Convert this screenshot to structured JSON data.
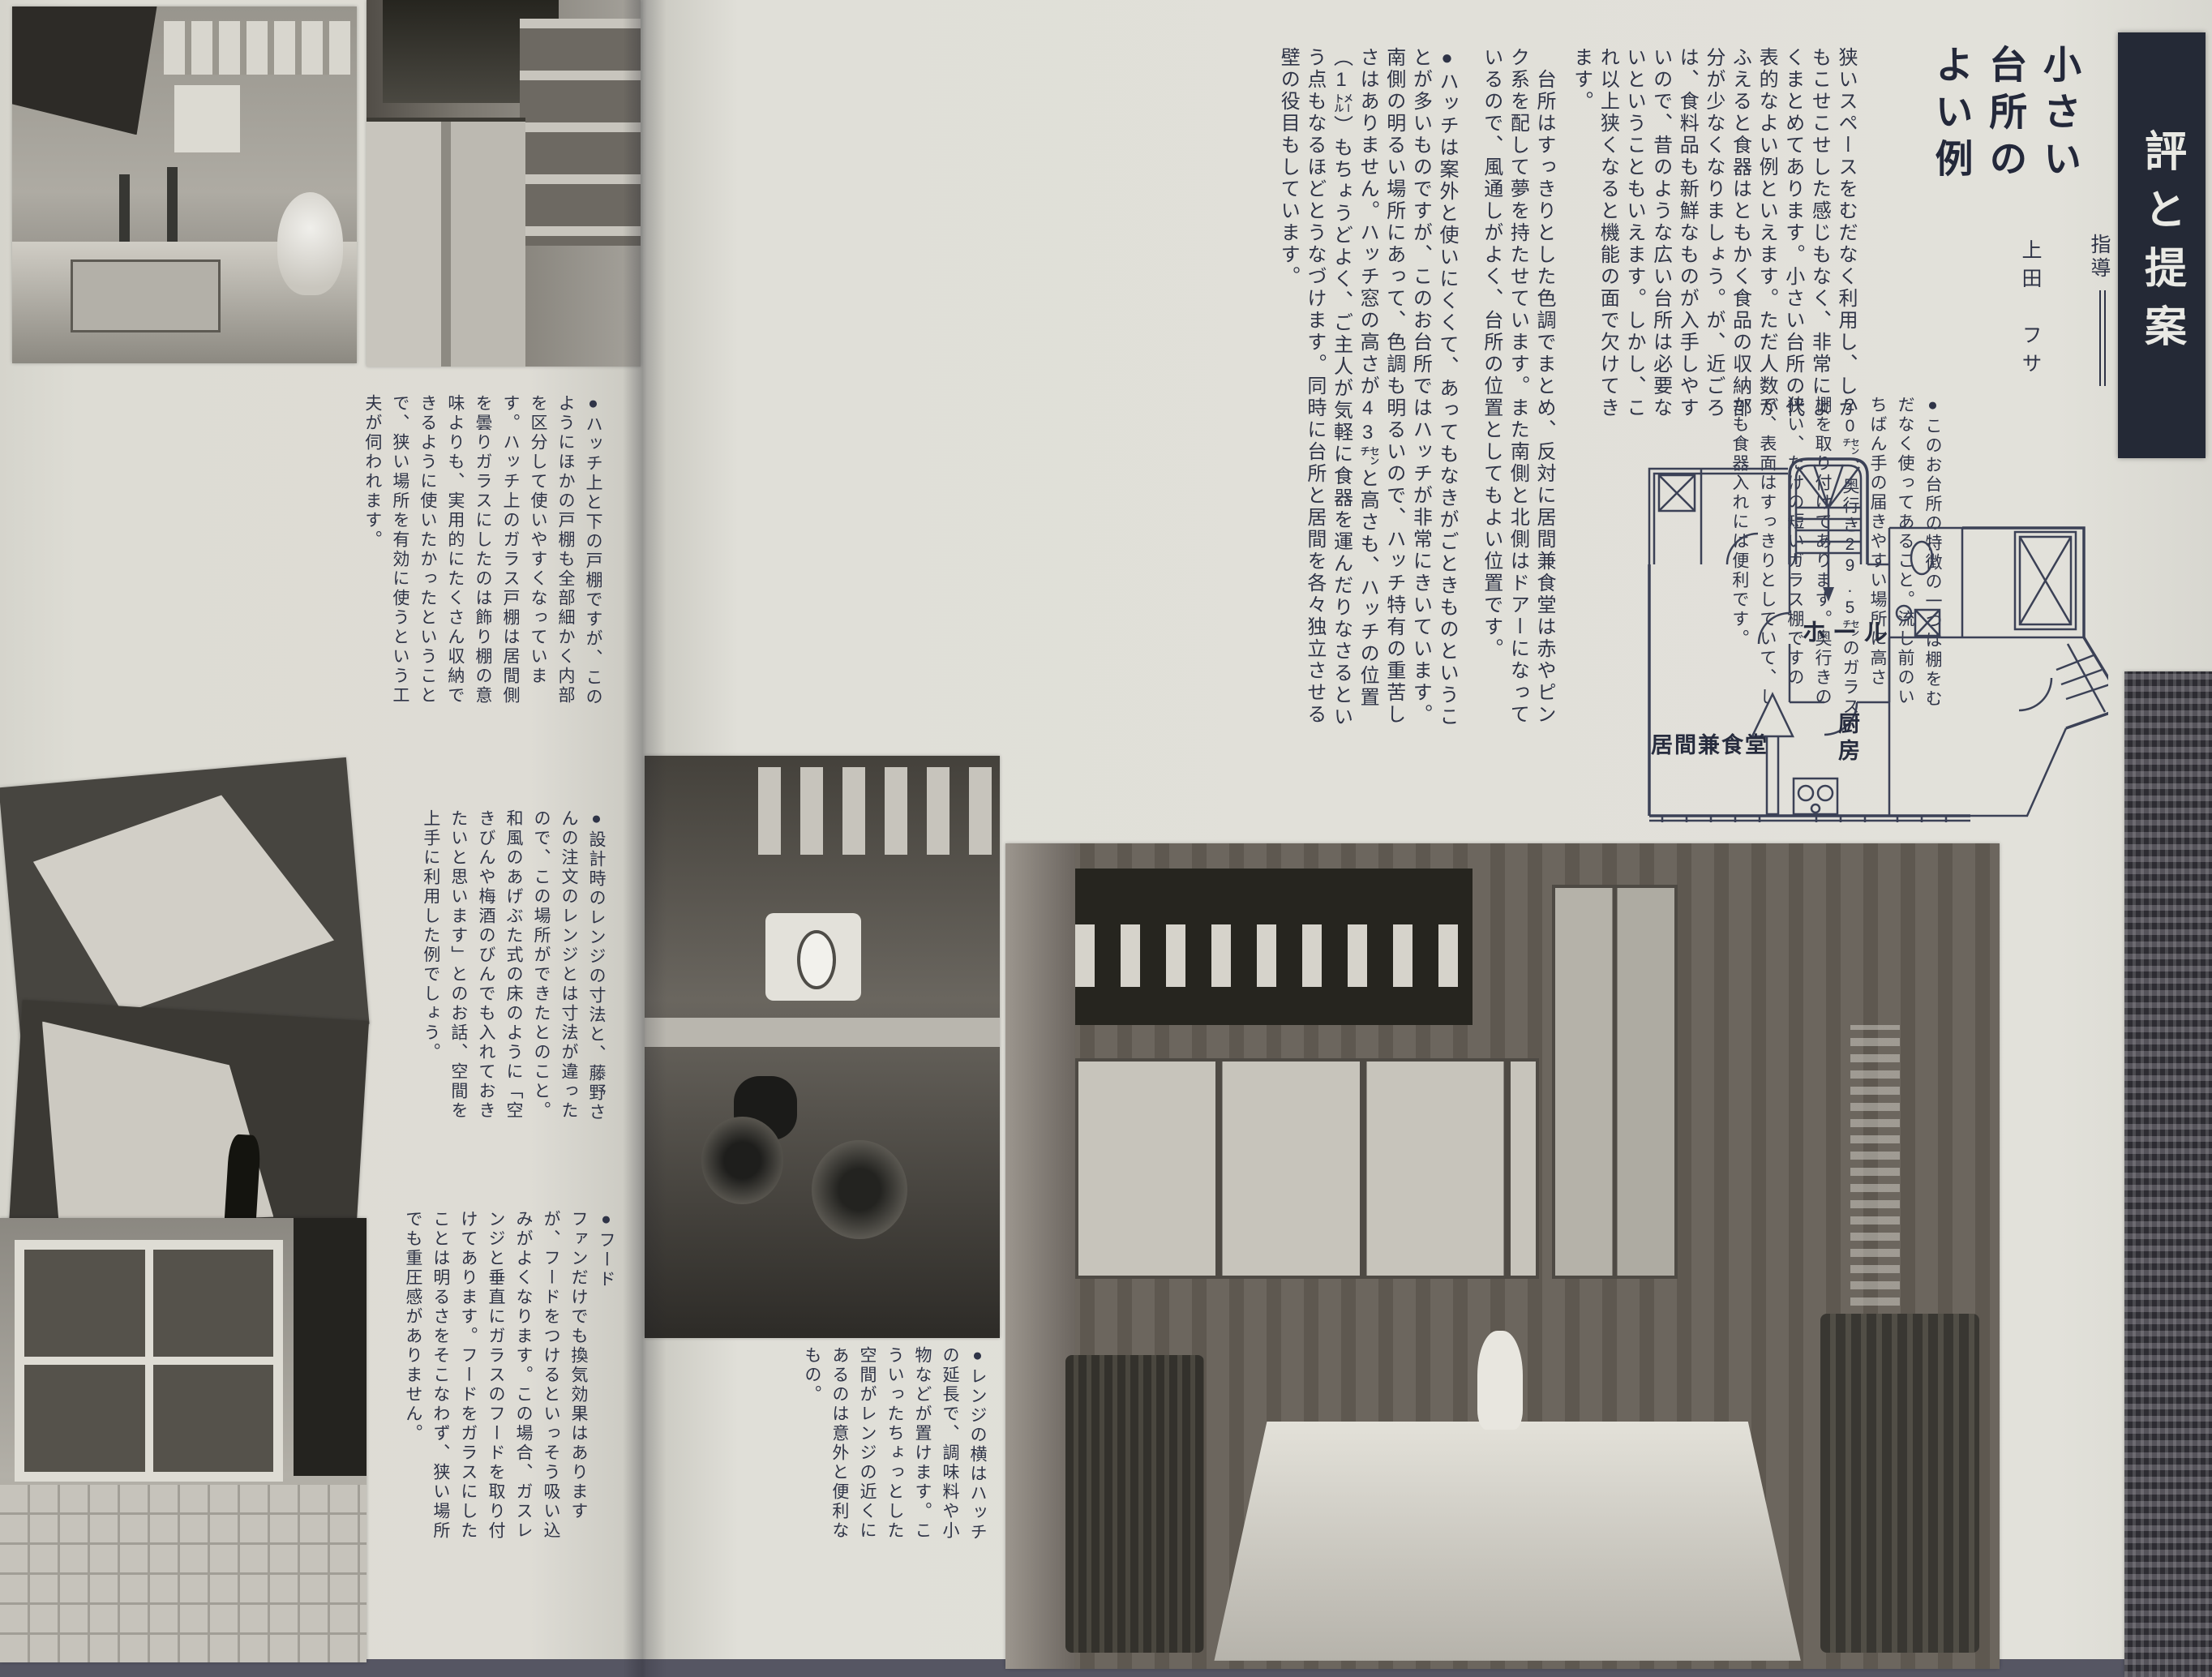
{
  "spread": {
    "tab": {
      "label": "評と提案",
      "bg": "#242936",
      "fg": "#e9e9e4"
    },
    "header": {
      "title": "小さい\n台所の\nよい例",
      "supervision_label": "指導",
      "supervisor_name": "上田　フサ"
    },
    "right_page": {
      "paragraphs": [
        "狭いスペースをむだなく利用し、しかもこせこせした感じもなく、非常によくまとめてあります。小さい台所の代表的なよい例といえます。ただ人数がふえると食器はともかく食品の収納部分が少なくなりましょう。が、近ごろは、食料品も新鮮なものが入手しやすいので、昔のような広い台所は必要ないということもいえます。しかし、これ以上狭くなると機能の面で欠けてきます。",
        "　台所はすっきりとした色調でまとめ、反対に居間兼食堂は赤やピンク系を配して夢を持たせています。また南側と北側はドアーになっているので、風通しがよく、台所の位置としてもよい位置です。",
        "●ハッチは案外と使いにくくて、あってもなきがごときものということが多いものですが、このお台所ではハッチが非常にきいています。南側の明るい場所にあって、色調も明るいので、ハッチ特有の重苦しさはありません。ハッチ窓の高さが43㌢と高さも、ハッチの位置（1㍍）もちょうどよく、ご主人が気軽に食器を運んだりなさるという点もなるほどとうなづけます。同時に台所と居間を各々独立させる壁の役目もしています。"
      ]
    },
    "floor_plan": {
      "labels": {
        "hall": "ホール",
        "kitchen": "厨房",
        "living_dining": "居間兼食堂"
      }
    },
    "left_page": {
      "blocks": [
        "●このお台所の特徴の一つは棚をむだなく使ってあること。流し前のいちばん手の届きやすい場所に高さ20㌢、奥行き29.5㌢のガラス棚を取り付けてあります。奥行きの狭い、たけの短いガラス棚ですので、表面はすっきりとしていて、しかも食器入れには便利です。",
        "●ハッチ上と下の戸棚ですが、このようにほかの戸棚も全部細かく内部を区分して使いやすくなっています。ハッチ上のガラス戸棚は居間側を曇りガラスにしたのは飾り棚の意味よりも、実用的にたくさん収納できるように使いたかったということで、狭い場所を有効に使うという工夫が伺われます。",
        "●設計時のレンジの寸法と、藤野さんの注文のレンジとは寸法が違ったので、この場所ができたとのこと。和風のあげぶた式の床のように「空きびんや梅酒のびんでも入れておきたいと思います」とのお話、空間を上手に利用した例でしょう。",
        "●フード\nファンだけでも換気効果はありますが、フードをつけるといっそう吸い込みがよくなります。この場合、ガスレンジと垂直にガラスのフードを取り付けてあります。フードをガラスにしたことは明るさをそこなわず、狭い場所でも重圧感がありません。",
        "●レンジの横はハッチの延長で、調味料や小物などが置けます。こういったちょっとした空間がレンジの近くにあるのは意外と便利なもの。"
      ]
    },
    "colors": {
      "paper": "#e0dfd8",
      "ink": "#2f3447",
      "tab_bg": "#242936",
      "plan_line": "#3b4156"
    }
  }
}
